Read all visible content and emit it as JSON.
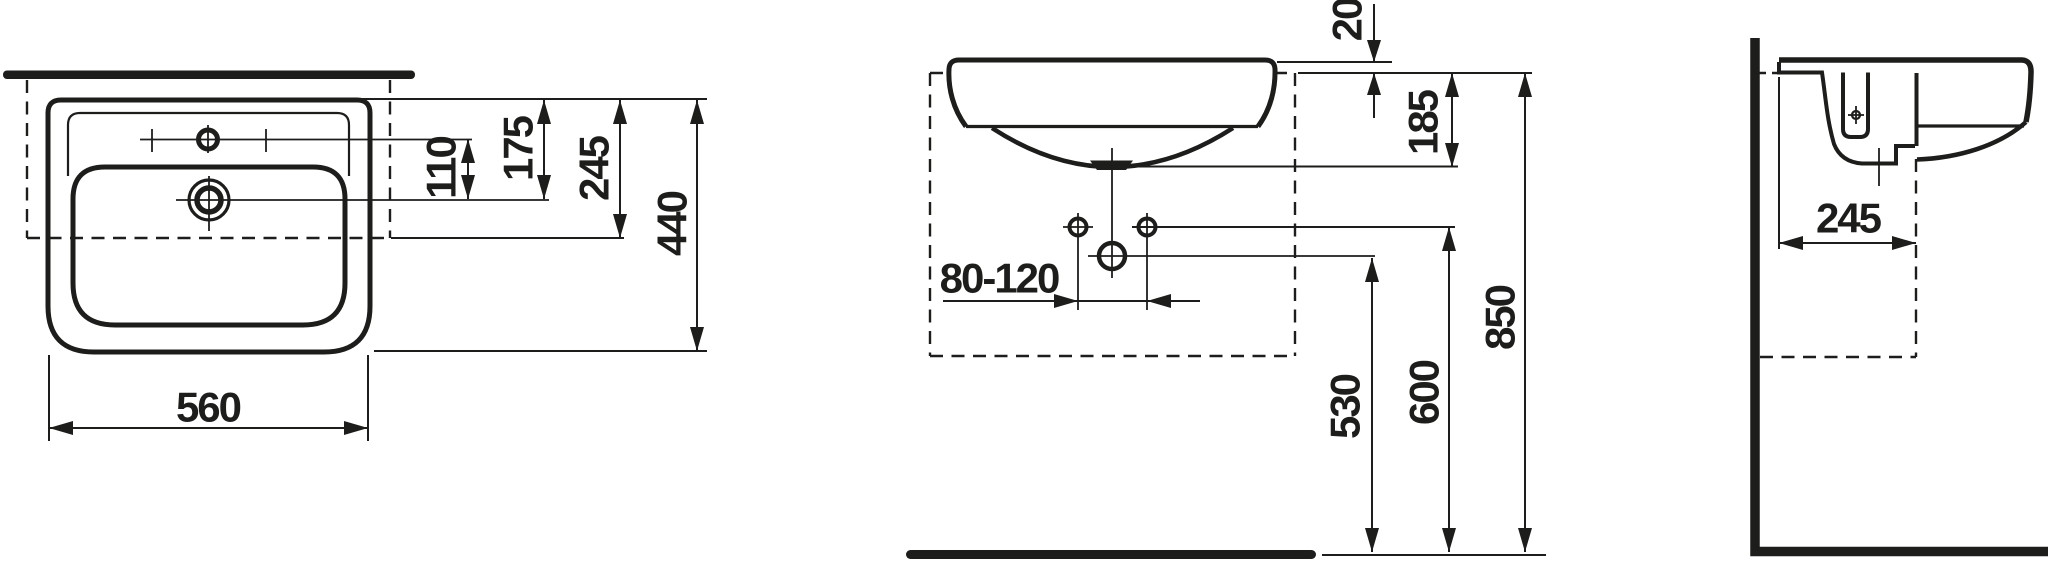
{
  "page": {
    "description": "Technical dimension drawing of a wall-mounted washbasin with plan view, front elevation and side section",
    "unit": "mm",
    "ink_color": "#1d1d1b",
    "background_color": "#ffffff"
  },
  "top_view": {
    "name": "plan view",
    "dims": {
      "basin_width": "560",
      "tap_to_drain": "110",
      "front_edge_to_drain": "175",
      "front_edge_to_mount": "245",
      "basin_depth": "440"
    }
  },
  "front_view": {
    "name": "front elevation",
    "dims": {
      "rim_to_mount": "20",
      "mount_to_overflow": "185",
      "tap_hole_spacing": "80-120",
      "outlet_height": "530",
      "fixing_height": "600",
      "rim_height": "850"
    }
  },
  "side_view": {
    "name": "side section",
    "dims": {
      "mount_depth": "245"
    }
  }
}
